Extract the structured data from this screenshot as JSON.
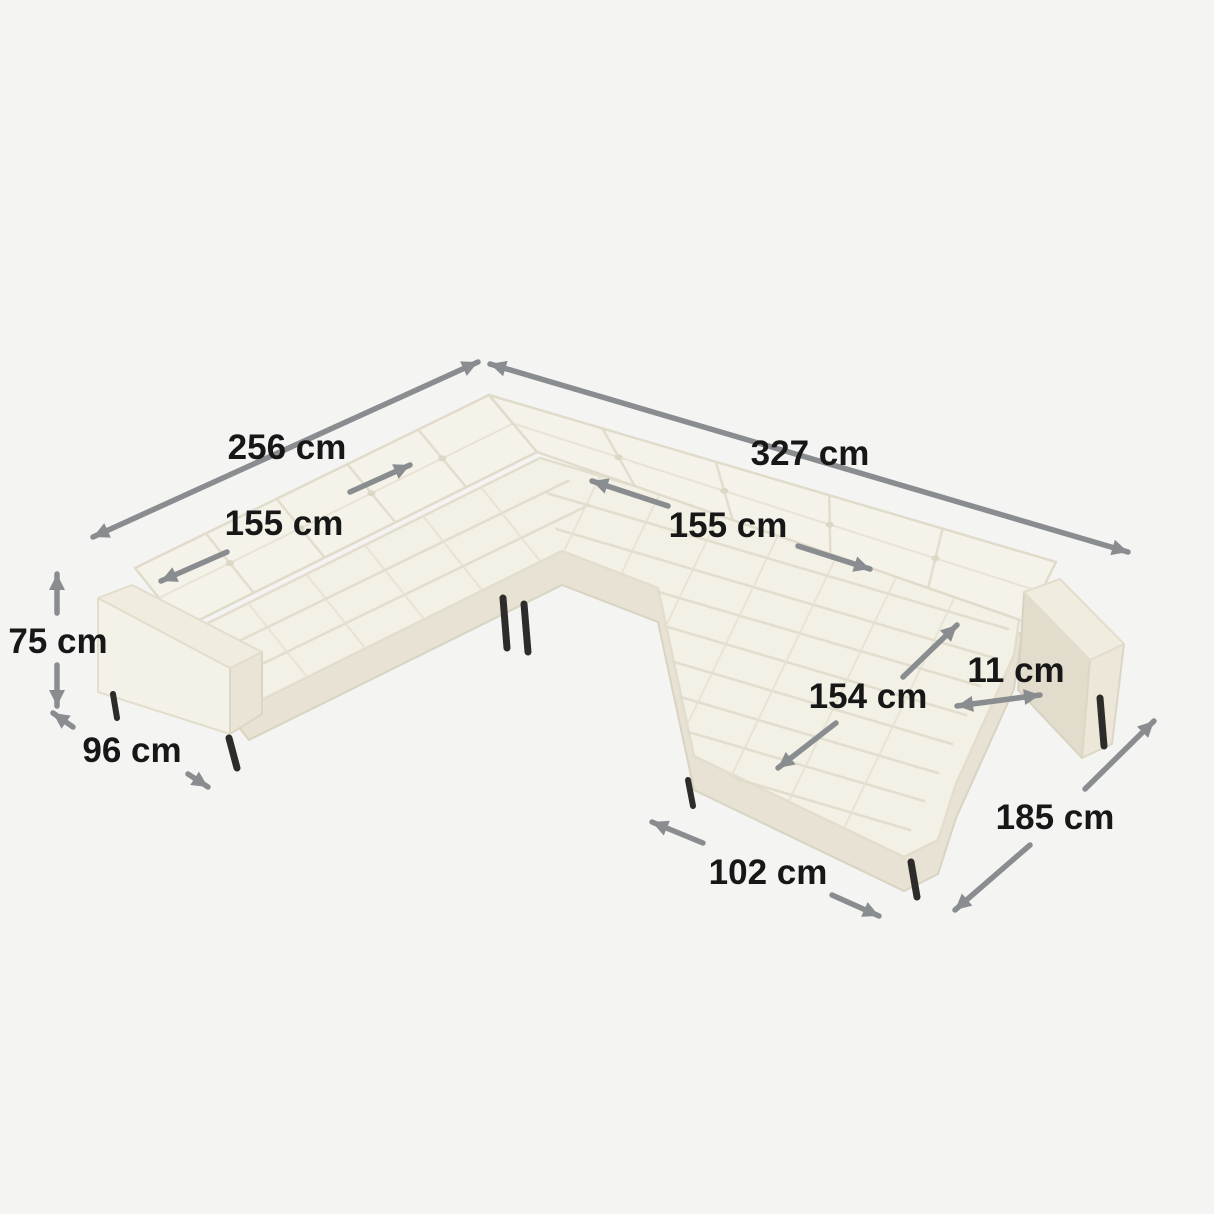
{
  "diagram": {
    "subject": "u-shaped-corner-sofa-dimension-diagram",
    "unit": "cm",
    "dimensions": [
      {
        "id": "back-left-width",
        "label": "256 cm",
        "value": 256
      },
      {
        "id": "back-right-width",
        "label": "327 cm",
        "value": 327
      },
      {
        "id": "seat-left-length",
        "label": "155 cm",
        "value": 155
      },
      {
        "id": "seat-right-length",
        "label": "155 cm",
        "value": 155
      },
      {
        "id": "height",
        "label": "75 cm",
        "value": 75
      },
      {
        "id": "depth",
        "label": "96 cm",
        "value": 96
      },
      {
        "id": "armrest-width",
        "label": "11 cm",
        "value": 11
      },
      {
        "id": "chaise-diagonal",
        "label": "154 cm",
        "value": 154
      },
      {
        "id": "chaise-side-length",
        "label": "185 cm",
        "value": 185
      },
      {
        "id": "chaise-front-width",
        "label": "102 cm",
        "value": 102
      }
    ],
    "colors": {
      "background": "#f4f4f2",
      "sofa_fabric": "#f3f0e6",
      "sofa_back": "#f5f2e9",
      "sofa_shadow": "#e7e2d3",
      "arrow": "#8a8d90",
      "label_text": "#171717",
      "legs": "#2d2c2a"
    }
  }
}
